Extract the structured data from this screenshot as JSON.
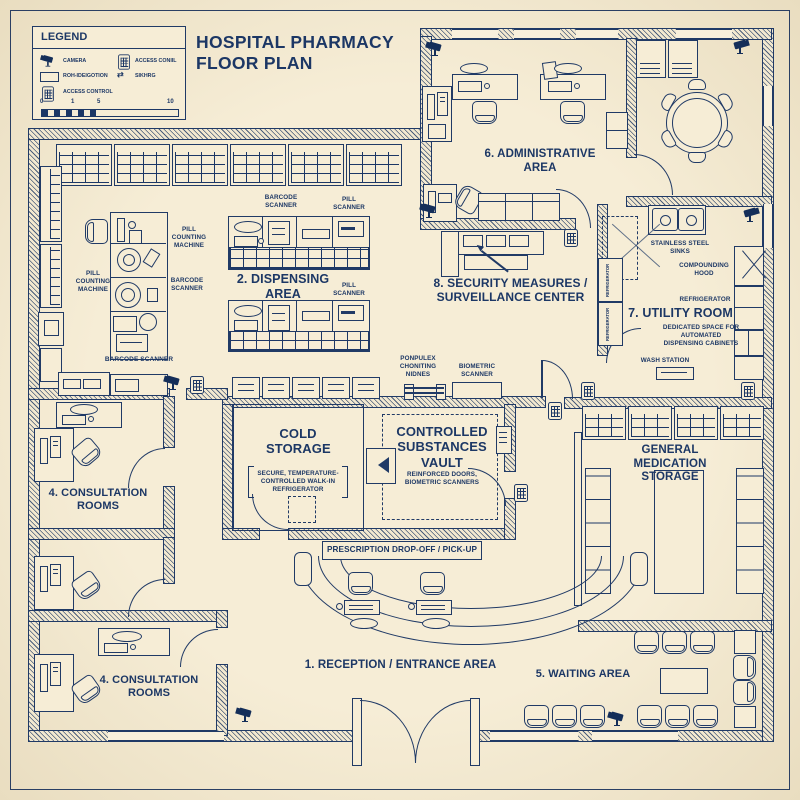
{
  "title": {
    "line1": "HOSPITAL PHARMACY",
    "line2": "FLOOR PLAN"
  },
  "legend": {
    "title": "LEGEND",
    "items": [
      {
        "icon": "camera-icon",
        "label": "CAMERA"
      },
      {
        "icon": "access-panel-icon",
        "label": "ACCESS CONIIL"
      },
      {
        "icon": "window-icon",
        "label": "ROH-IDEIGOTION"
      },
      {
        "icon": "shelving-arrows-icon",
        "label": "SIKHRG"
      },
      {
        "icon": "keypad-icon",
        "label": "ACCESS CONTROL"
      }
    ],
    "scale_ticks": [
      "0",
      "1",
      "5",
      "10"
    ]
  },
  "rooms": {
    "reception": "1. RECEPTION / ENTRANCE AREA",
    "dispensing": "2. DISPENSING AREA",
    "consultation_upper": "4. CONSULTATION ROOMS",
    "consultation_lower": "4. CONSULTATION ROOMS",
    "waiting": "5. WAITING AREA",
    "administrative": "6. ADMINISTRATIVE AREA",
    "utility": "7. UTILITY ROOM",
    "security": "8. SECURITY MEASURES / SURVEILLANCE CENTER"
  },
  "features": {
    "cold_storage_title": "COLD STORAGE",
    "cold_storage_desc": "SECURE, TEMPERATURE-CONTROLLED WALK-IN REFRIGERATOR",
    "vault_title": "CONTROLLED SUBSTANCES VAULT",
    "vault_desc": "REINFORCED DOORS, BIOMETRIC SCANNERS",
    "general_storage": "GENERAL MEDICATION STORAGE",
    "prescription_counter": "PRESCRIPTION DROP-OFF / PICK-UP"
  },
  "equipment": {
    "pill_counting_a": "PILL COUNTING MACHINE",
    "pill_counting_b": "PILL COUNTING MACHINE",
    "barcode_a": "BARCODE SCANNER",
    "barcode_b": "BARCODE SCANNER",
    "barcode_c": "BARCODE SCANNER",
    "pill_scanner_a": "PILL SCANNER",
    "pill_scanner_b": "PILL SCANNER",
    "biometric_scanner": "BIOMETRIC SCANNER",
    "counting_machines": "PONPULEX CHONITING NIDNES",
    "stainless_sinks": "STAINLESS STEEL SINKS",
    "compounding_hood": "COMPOUNDING HOOD",
    "refrigerator": "REFRIGERATOR",
    "refrigerator_cab_a": "REFRIGERATOR",
    "refrigerator_cab_b": "REFRIGERATOR",
    "dedicated_space": "DEDICATED SPACE FOR AUTOMATED DISPENSING CABINETS",
    "wash_station": "WASH STATION"
  },
  "colors": {
    "ink": "#1c3765",
    "paper": "#f5ecd4",
    "wall_fill": "#f3e9d0"
  }
}
